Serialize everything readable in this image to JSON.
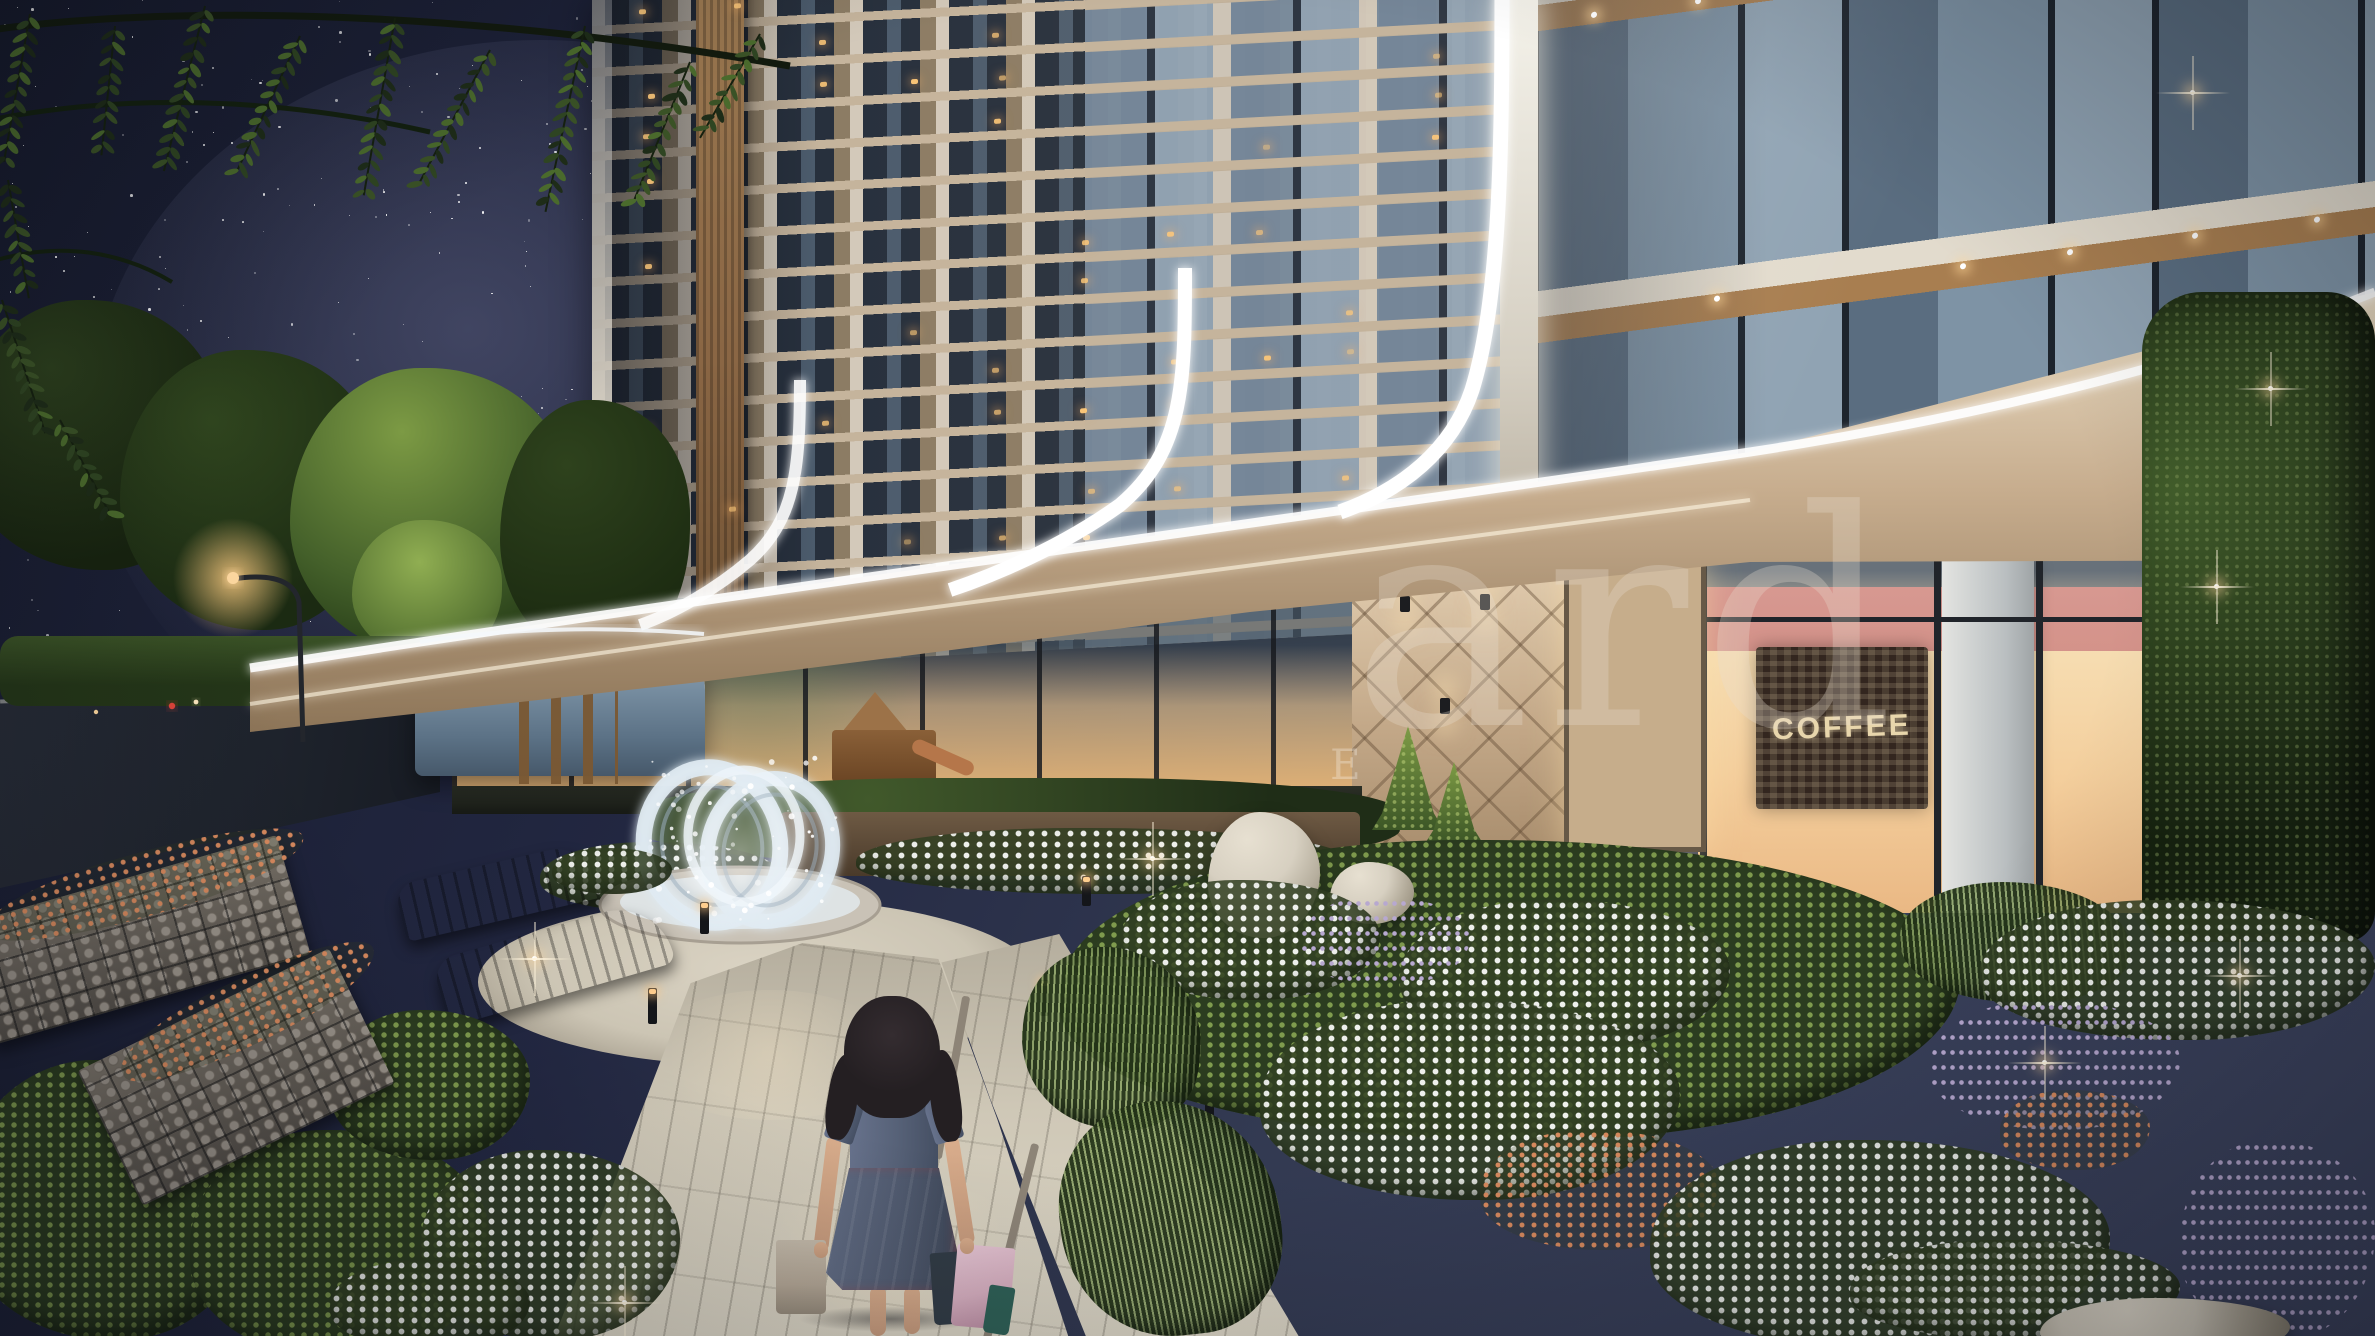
{
  "scene": {
    "type": "architectural-render-night",
    "description": "Night 3D rendering of a modern residential complex: a tall beige apartment tower with lit balconies and curving white LED ribbons, ground-floor shops including a coffee shop, a landscaped garden with white and purple flowers, rocks, a glass double-ring fountain, curved wooden benches, gabion walls, a starry sky with overhanging tree branches, and a girl in a blue dress carrying shopping bags on a paved path.",
    "entities": [
      "starry-sky",
      "tree-branches",
      "apartment-tower",
      "near-wing-building",
      "led-light-ribbons",
      "canopy",
      "storefront",
      "entrance",
      "coffee-shop",
      "glass-pavilion",
      "street-lamp",
      "road",
      "fountain-rings",
      "plaza",
      "walking-path",
      "girl-with-bags",
      "playground",
      "benches",
      "gabion-wall",
      "flower-beds",
      "rocks",
      "conifer-hedge",
      "path-bollards",
      "garden-lights"
    ]
  },
  "watermark": {
    "large_text": "ard",
    "small_text": "E"
  },
  "coffee_shop": {
    "sign_text": "COFFEE"
  },
  "palette": {
    "sky_top": "#161a2c",
    "sky_mid": "#333a52",
    "star": "#ffffff",
    "facade_slab": "#c5b49c",
    "facade_pier": "#d3c9ba",
    "facade_glass_dark": "#27303d",
    "facade_glass_mid": "#4c5c6d",
    "facade_slate": "#78899b",
    "wood_column": "#8a6644",
    "wood_soffit": "#a87e50",
    "warm_window": "#ffc87e",
    "led_white": "#ffffff",
    "canopy_warm": "#c7ad8e",
    "storefront_glow": "#ffd9a2",
    "interior_pink": "#e09a92",
    "interior_red": "#c23f33",
    "coffee_panel": "#33261f",
    "coffee_text": "#e8d6ac",
    "garden_dark": "#1f2d19",
    "garden_mid": "#3b5226",
    "garden_light": "#6f8f3f",
    "flower_white": "#eef0ec",
    "flower_purple": "#b7a8d0",
    "flower_orange": "#d88a5e",
    "path_light": "#ccc5b4",
    "road_dark": "#1e232c",
    "rock_light": "#d7d0c1",
    "gabion_grey": "#6f685f",
    "bench_wood": "#7e5530",
    "pavilion_glass": "#8fa6b8",
    "fountain_ring": "#dfeaf2",
    "hair_dark": "#241f22",
    "dress_blue": "#566177",
    "skin": "#c79b7d",
    "bag_kraft": "#b5a897",
    "bag_pink": "#d8b0c1",
    "bag_teal": "#2f6157",
    "bag_dark": "#323c46",
    "watermark": "#e9dfd2"
  }
}
